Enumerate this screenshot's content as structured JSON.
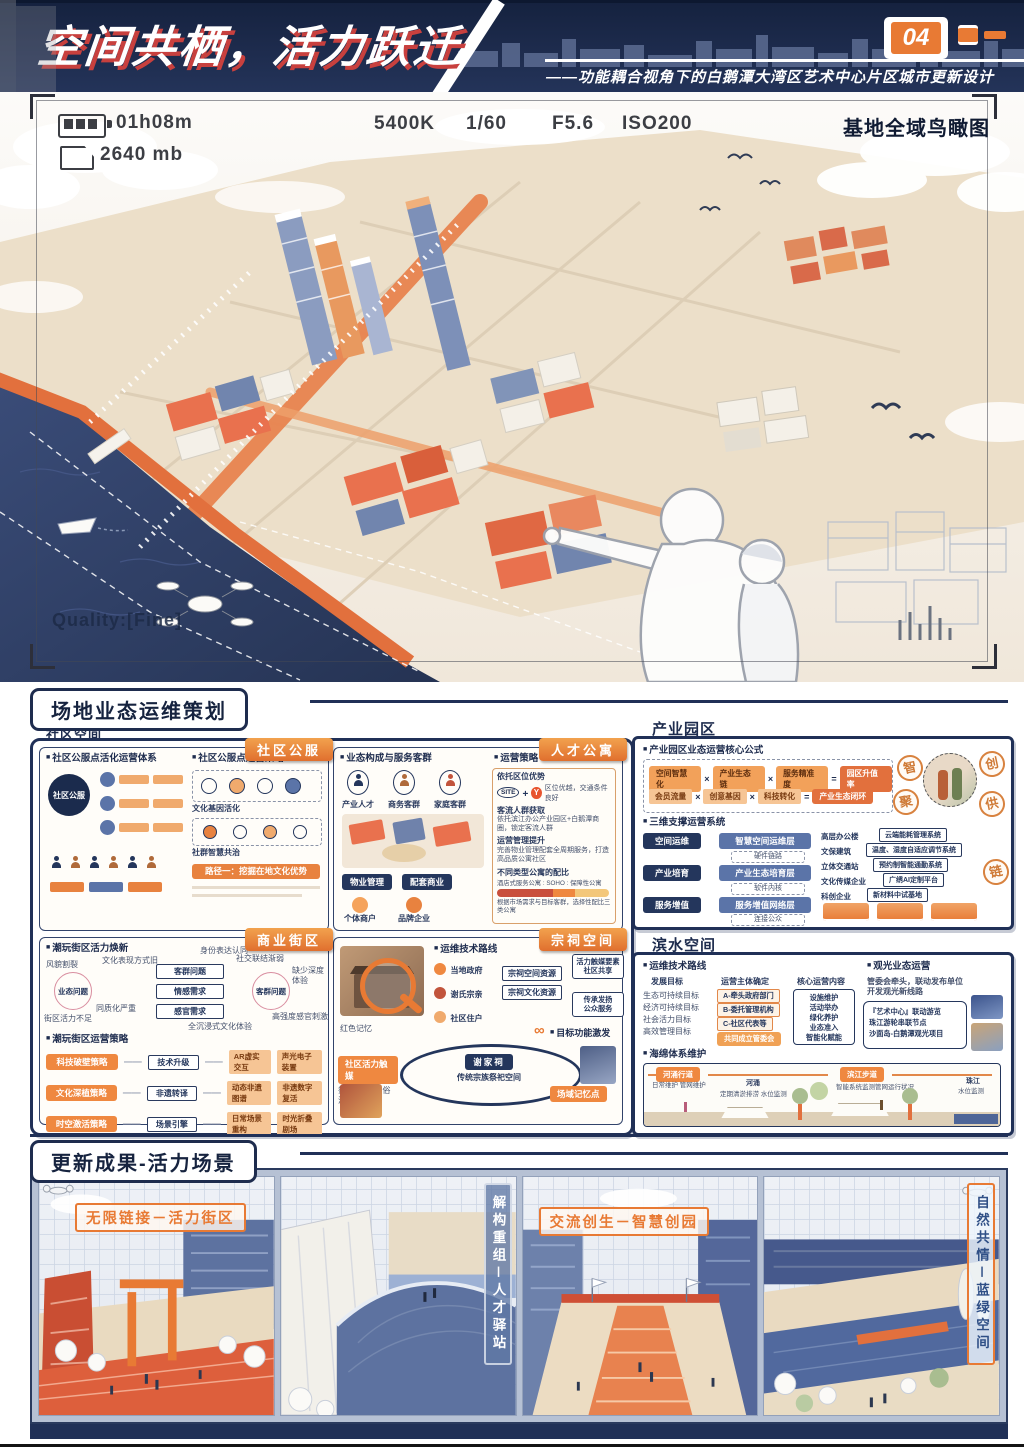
{
  "colors": {
    "navy": "#1e2c4e",
    "orange": "#e87a34",
    "red": "#c8403e",
    "water": "#2c3c63",
    "beige": "#ecdfc9"
  },
  "header": {
    "title": "空间共栖，活力跃迁",
    "badge": "04",
    "subtitle": "——功能耦合视角下的白鹅潭大湾区艺术中心片区城市更新设计"
  },
  "vf": {
    "time": "01h08m",
    "storage": "2640 mb",
    "wb": "5400K",
    "shutter": "1/60",
    "aperture": "F5.6",
    "iso": "ISO200",
    "view": "基地全域鸟瞰图",
    "quality": "Quality:[Fine]"
  },
  "ops": {
    "title": "场地业态运维策划",
    "group": "社区空间"
  },
  "cs": {
    "tag": "社区公服",
    "t1": "社区公服点活化运营体系",
    "hub": "社区公服",
    "t2": "社区公服点运营策略",
    "i1": "文化基因活化",
    "i2": "社群智慧共治",
    "path": "路径一：挖掘在地文化优势"
  },
  "ta": {
    "tag": "人才公寓",
    "t1": "业态构成与服务客群",
    "g": [
      "产业人才",
      "商务客群",
      "家庭客群"
    ],
    "t2": "运营策略",
    "site": "SITE",
    "y": "Y",
    "r": [
      {
        "t": "依托区位优势",
        "d": "区位优越，交通条件良好"
      },
      {
        "t": "客流人群获取",
        "d": "依托滨江办公产业园区+白鹅潭商圈，锁定客流人群"
      },
      {
        "t": "运营管理提升",
        "d": "完善物业管理配套全周期服务，打造高品质公寓社区"
      }
    ],
    "rt": "不同类型公寓的配比",
    "rl": "酒店式服务公寓 : SOHO : 保障性公寓",
    "rn": "根据市场需求与目标客群，选择性配比三类公寓",
    "tags": [
      "物业管理",
      "配套商业"
    ],
    "actors": [
      "个体商户",
      "品牌企业"
    ]
  },
  "cb": {
    "tag": "商业街区",
    "t1": "潮玩街区活力焕新",
    "c1": "业态问题",
    "c2": "客群问题",
    "mid": [
      "客群问题",
      "情感需求",
      "感官需求"
    ],
    "n": [
      "风貌割裂",
      "文化表现方式旧",
      "街区活力不足",
      "同质化严重",
      "社交联结渐弱",
      "身份表达认同",
      "缺少深度体验",
      "高强度感官刺激",
      "全沉浸式文化体验"
    ],
    "t2": "潮玩街区运营策略",
    "s": [
      {
        "a": "科技破壁策略",
        "b": "技术升级",
        "c": "AR虚实交互",
        "d": "声光电子装置"
      },
      {
        "a": "文化深植策略",
        "b": "非遗转译",
        "c": "动态非遗图谱",
        "d": "非遗数字复活"
      },
      {
        "a": "时空激活策略",
        "b": "场景引擎",
        "c": "日常场景重构",
        "d": "时光折叠剧场"
      }
    ]
  },
  "an": {
    "tag": "宗祠空间",
    "t1": "运维技术路线",
    "actors": [
      "当地政府",
      "谢氏宗亲",
      "社区住户"
    ],
    "res": [
      "宗祠空间资源",
      "宗祠文化资源"
    ],
    "o1": [
      "活力触媒要素",
      "社区共享"
    ],
    "o2": [
      "传承发扬",
      "公众服务"
    ],
    "t2": "目标功能激发",
    "center": "谢家祠",
    "sub": "传统宗族祭祀空间",
    "mem": "红色记忆",
    "k1": "社区活力触媒",
    "k1s": "祭祀 节庆 民俗活动",
    "k2": "场域记忆点"
  },
  "ind": {
    "label": "产业园区",
    "t1": "产业园区业态运营核心公式",
    "mul": "×",
    "eq": "=",
    "f1": [
      "空间智慧化",
      "产业生态链",
      "服务精准度",
      "园区升值率"
    ],
    "f2": [
      "会员流量",
      "创意基因",
      "科技转化",
      "产业生态闭环"
    ],
    "stamps": [
      "智",
      "创",
      "聚",
      "供",
      "链"
    ],
    "t2": "三维支撑运营系统",
    "flow": [
      {
        "k": "空间运维",
        "v": "智慧空间运维层",
        "s": "硬件链路"
      },
      {
        "k": "产业培育",
        "v": "产业生态培育层",
        "s": "软件内核"
      },
      {
        "k": "服务增值",
        "v": "服务增值网络层",
        "s": "连接公众"
      }
    ],
    "items": [
      {
        "k": "高层办公楼",
        "v": "云端能耗管理系统"
      },
      {
        "k": "文保建筑",
        "v": "温度、湿度自适应调节系统"
      },
      {
        "k": "立体交通站",
        "v": "预约制智能通勤系统"
      },
      {
        "k": "文化传媒企业",
        "v": "广绣AI定制平台"
      },
      {
        "k": "科创企业",
        "v": "新材料中试基地"
      }
    ]
  },
  "wf": {
    "label": "滨水空间",
    "t1": "运维技术路线",
    "c1": "发展目标",
    "goals": [
      "生态可持续目标",
      "经济可持续目标",
      "社会活力目标",
      "高效管理目标"
    ],
    "c2": "运营主体确定",
    "bodies": [
      "A-牵头政府部门",
      "B-委托管理机构",
      "C-社区代表等"
    ],
    "br": "共同成立管委会",
    "c3": "核心运营内容",
    "contents": [
      "设施维护",
      "活动举办",
      "绿化养护",
      "业态准入",
      "智能化赋能"
    ],
    "t2": "观光业态运营",
    "lead": "管委会牵头，联动发布单位",
    "lead2": "开发观光新线路",
    "sights": [
      "『艺术中心』联动游览",
      "珠江游轮串联节点",
      "沙面岛-白鹅潭观光项目"
    ],
    "t3": "海绵体系维护",
    "tagA": "河涌行道",
    "tagB": "滨江步道",
    "l0": "日常维护 管网维护",
    "l1": "河涌",
    "l2": "定期清淤排涝 水位监测",
    "l3": "智能系统监测管网运行状况",
    "l4": "珠江",
    "l5": "水位监测"
  },
  "res": {
    "title": "更新成果-活力场景",
    "scenes": [
      "无限链接－活力街区",
      "解构重组－人才驿站",
      "交流创生－智慧创园",
      "自然共情－蓝绿空间"
    ]
  }
}
